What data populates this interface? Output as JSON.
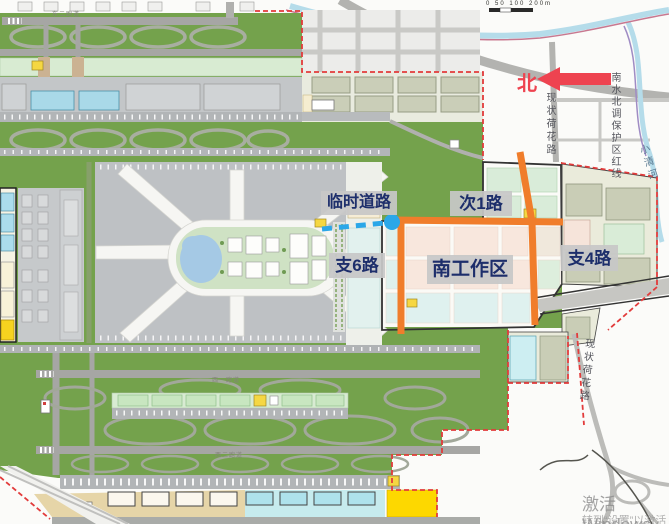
{
  "map_labels": {
    "temp_road": "临时道路",
    "ci1_road": "次1路",
    "zhi6_road": "支6路",
    "south_work_area": "南工作区",
    "zhi4_road": "支4路"
  },
  "compass": {
    "north": "北"
  },
  "scale_bar": {
    "text": "0 50 100 200m"
  },
  "road_names": {
    "hehua_north": "现状荷花路",
    "hehua_south": "现状荷花路",
    "nanshui_beidiao": "南水北调保护区红线",
    "xiaoqing_river": "小清河"
  },
  "runway_labels": {
    "north": "东二跑道",
    "mid": "西一跑道",
    "south": "西二跑道"
  },
  "watermark": {
    "line1": "激活 Windows",
    "line2": "转到“设置”以激活 Windows。"
  },
  "colors": {
    "planned_road_orange": "#f07d2b",
    "temp_road_blue": "#2ba7e8",
    "north_red": "#ee4350",
    "label_text_navy": "#1d2e6b",
    "label_bg_grey": "#c8c8c8",
    "boundary_red_dash": "#e23b3b",
    "airfield_green": "#74a24c",
    "apron_grey": "#bec1c4",
    "work_area_pink": "#f8e7dd",
    "work_area_cyan": "#dff1ef"
  }
}
